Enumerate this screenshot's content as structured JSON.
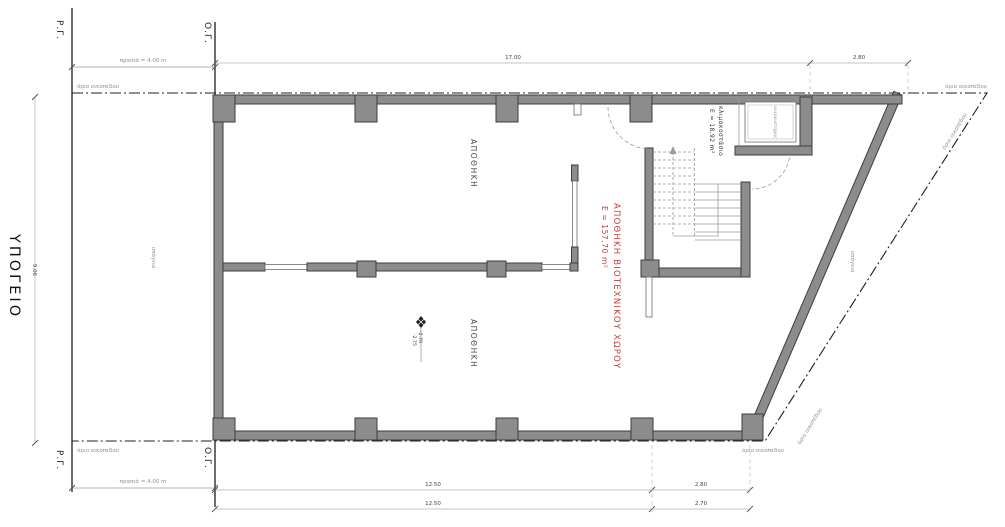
{
  "title": "ΥΠΟΓΕΙΟ",
  "reference_lines": {
    "rg_top": "Ρ.Γ.",
    "og_top": "Ο.Γ.",
    "rg_bottom": "Ρ.Γ.",
    "og_bottom": "Ο.Γ."
  },
  "setbacks": {
    "top": "πρασιά = 4.00 m",
    "bottom": "πρασιά = 4.00 m"
  },
  "boundary": {
    "label_top_left": "όριο οικοπέδου",
    "label_top_right": "όριο οικοπέδου",
    "label_bottom_left": "όριο οικοπέδου",
    "label_bottom_right": "όριο οικοπέδου",
    "label_diagonal_upper": "όριο οικοπέδου",
    "label_diagonal_lower": "όριο οικοπέδου"
  },
  "dimensions": {
    "top_width": "17.00",
    "top_right_width": "2.80",
    "left_height": "9.06",
    "bottom_row1_main": "12.50",
    "bottom_row1_right": "2.80",
    "bottom_row2_main": "12.50",
    "bottom_row2_right": "2.70"
  },
  "rooms": {
    "storage_upper": "ΑΠΟΘΗΚΗ",
    "storage_lower": "ΑΠΟΘΗΚΗ",
    "industrial_storage_title": "ΑΠΟΘΗΚΗ ΒΙΟΤΕΧΝΙΚΟΥ ΧΩΡΟΥ",
    "industrial_storage_area": "E = 157.70 m²",
    "staircase_title": "κλιμακοστάσιο",
    "staircase_area": "E = 18.92 m²",
    "elevator": "ανελκυστήρας",
    "basement_note_left": "υπόγειο",
    "basement_note_right": "υπόγειο"
  },
  "levels": {
    "upper": "-2.70",
    "lower": "-2.75"
  },
  "colors": {
    "wall_fill": "#8c8c8c",
    "wall_stroke": "#3d3d3d",
    "red_label": "#c23b3b",
    "dim_line": "#b0b0b0",
    "gray_label": "#8f8f8f",
    "boundary_line": "#1f1f1f"
  }
}
